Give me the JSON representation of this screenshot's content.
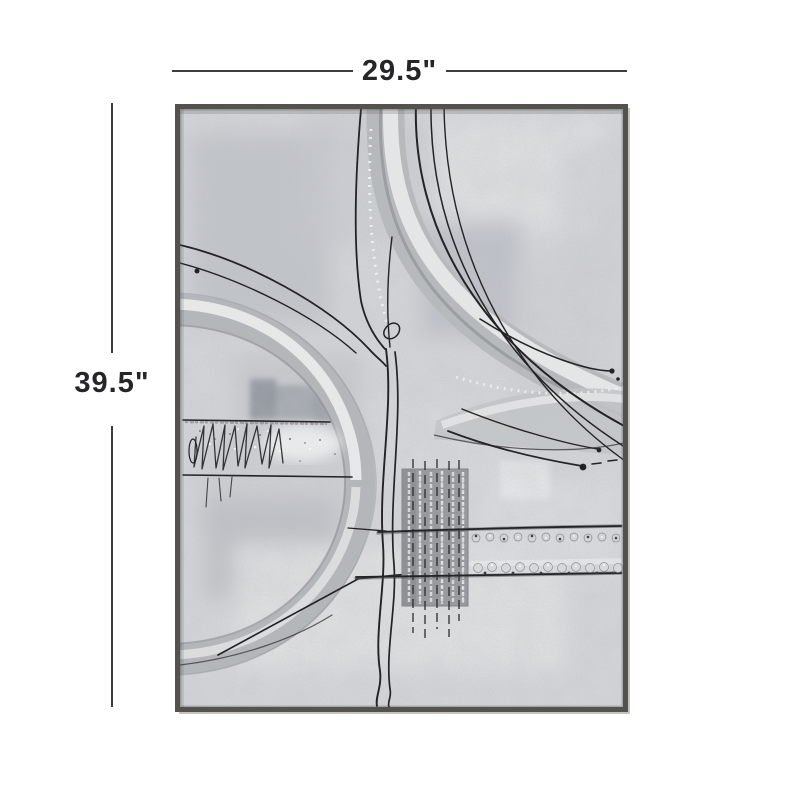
{
  "page": {
    "background": "#ffffff"
  },
  "dimension_annotations": {
    "width": {
      "label": "29.5\""
    },
    "height": {
      "label": "39.5\""
    },
    "line_color": "#3d3d3f",
    "text_color": "#262628"
  },
  "artwork": {
    "description": "abstract gray and silver framed canvas wall art",
    "frame_color": "#55514c",
    "frame_lip_color": "#c6c4c1",
    "canvas_base_color": "#d6d8da",
    "metal_accent_color": "#c2c5c7",
    "paint_line_color": "#1c1c1e"
  }
}
